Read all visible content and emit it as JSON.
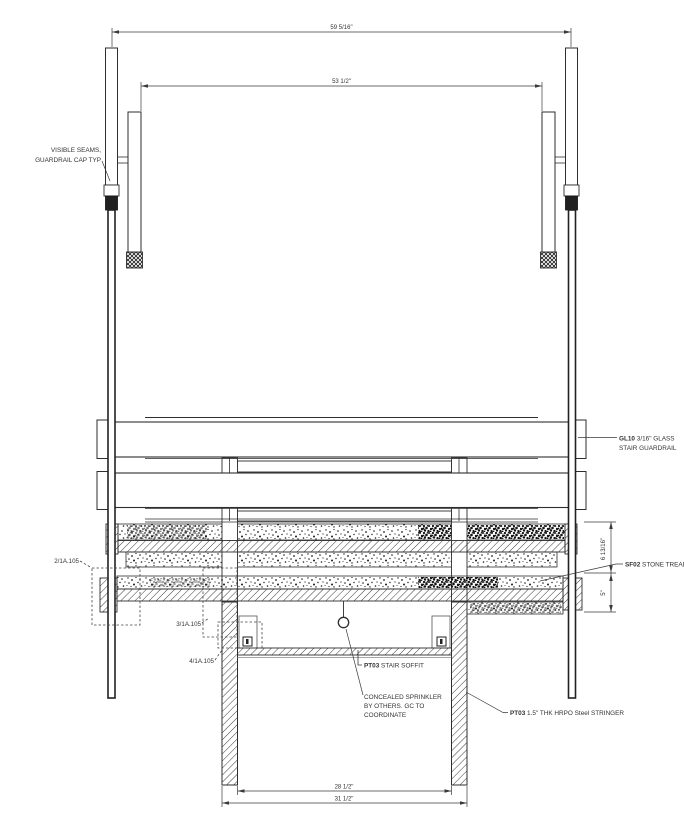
{
  "drawing": {
    "dimensions": {
      "overall_width": "59 5/16\"",
      "rail_width": "53 1/2\"",
      "tread_height_upper": "6 13/16\"",
      "tread_height_lower": "5\"",
      "soffit_inner_width": "28 1/2\"",
      "soffit_outer_width": "31 1/2\""
    },
    "labels": {
      "visible_seams_line1": "VISIBLE SEAMS,",
      "visible_seams_line2": "GUARDRAIL CAP TYP",
      "glass_tag": "GL10",
      "glass_rest": " 3/16\" GLASS",
      "glass_line2": "STAIR GUARDRAIL",
      "stone_tag": "SF02",
      "stone_rest": " STONE TREAD",
      "soffit_tag": "PT03",
      "soffit_rest": " STAIR SOFFIT",
      "sprinkler_line1": "CONCEALED SPRINKLER",
      "sprinkler_line2": "BY OTHERS. GC TO",
      "sprinkler_line3": "COORDINATE",
      "stringer_tag": "PT03",
      "stringer_rest": " 1.5\" THK HRPO Steel STRINGER",
      "ref_detail_2": "2/1A.105",
      "ref_detail_3": "3/1A.105",
      "ref_detail_4": "4/1A.105"
    }
  }
}
